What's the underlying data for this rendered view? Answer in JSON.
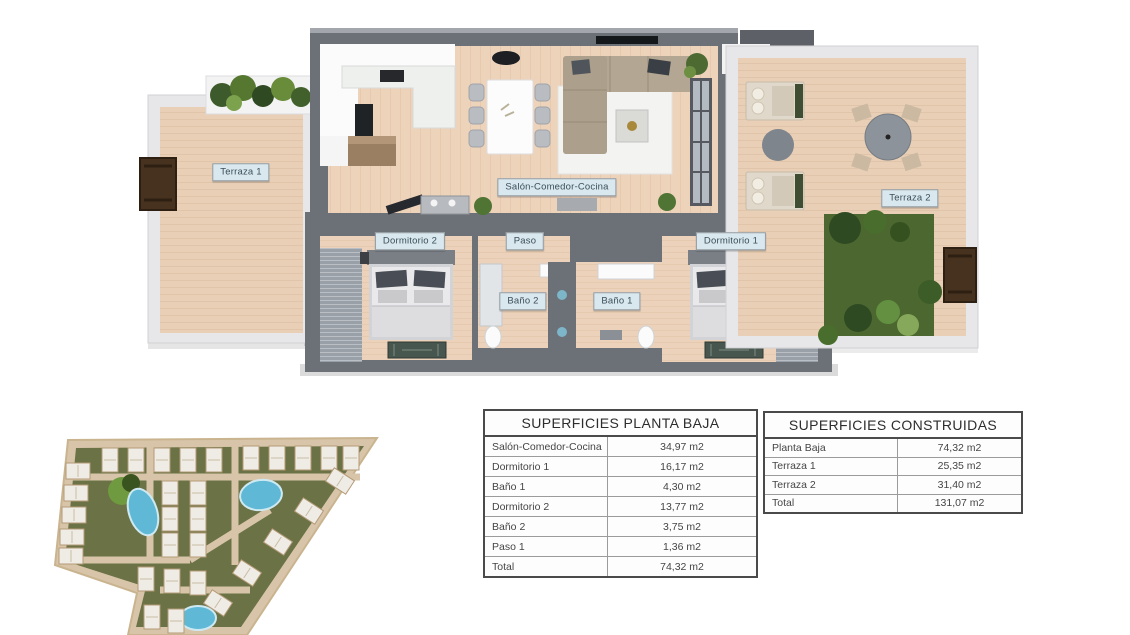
{
  "floor_plan": {
    "labels": {
      "terraza1": "Terraza 1",
      "salon": "Salón-Comedor-Cocina",
      "dormitorio2": "Dormitorio 2",
      "paso": "Paso",
      "dormitorio1": "Dormitorio 1",
      "bano2": "Baño 2",
      "bano1": "Baño 1",
      "terraza2": "Terraza 2"
    }
  },
  "tables": {
    "planta_baja": {
      "title": "SUPERFICIES PLANTA BAJA",
      "rows": [
        {
          "label": "Salón-Comedor-Cocina",
          "value": "34,97 m2"
        },
        {
          "label": "Dormitorio 1",
          "value": "16,17 m2"
        },
        {
          "label": "Baño 1",
          "value": "4,30 m2"
        },
        {
          "label": "Dormitorio 2",
          "value": "13,77 m2"
        },
        {
          "label": "Baño 2",
          "value": "3,75 m2"
        },
        {
          "label": "Paso 1",
          "value": "1,36 m2"
        },
        {
          "label": "Total",
          "value": "74,32 m2"
        }
      ]
    },
    "construidas": {
      "title": "SUPERFICIES CONSTRUIDAS",
      "rows": [
        {
          "label": "Planta Baja",
          "value": "74,32 m2"
        },
        {
          "label": "Terraza 1",
          "value": "25,35 m2"
        },
        {
          "label": "Terraza 2",
          "value": "31,40 m2"
        },
        {
          "label": "Total",
          "value": "131,07 m2"
        }
      ]
    }
  },
  "colors": {
    "wall": "#6c7077",
    "wood_floor": "#eed3bb",
    "deck": "#e9cfb5",
    "lawn": "#4c672f",
    "label_bg": "#d8e8ee",
    "pool": "#5fb9d6",
    "site_road": "#d8c5a9"
  }
}
